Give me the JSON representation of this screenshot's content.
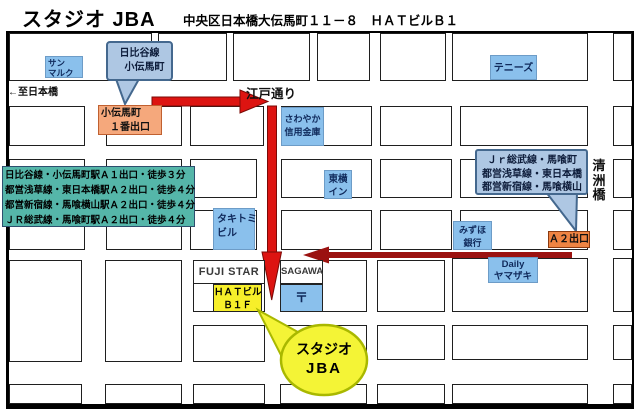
{
  "header": {
    "title": "スタジオ JBA",
    "address": "中央区日本橋大伝馬町１１－８　ＨＡＴビルＢ１"
  },
  "roads": {
    "to_nihonbashi": "←至日本橋",
    "edo_dori": "江戸通り",
    "kiyosubashi": [
      "清",
      "洲",
      "橋"
    ]
  },
  "station_callout": {
    "line1": "日比谷線",
    "line2": "小伝馬町"
  },
  "exits": {
    "kodemmacho_exit1": {
      "line1": "小伝馬町",
      "line2": "１番出口"
    },
    "a2": "Ａ２出口"
  },
  "access_info": {
    "lines": [
      "日比谷線・小伝馬町駅Ａ１出口・徒歩３分",
      "都営浅草線・東日本橋駅Ａ２出口・徒歩４分",
      "都営新宿線・馬喰横山駅Ａ２出口・徒歩４分",
      "ＪＲ総武線・馬喰町駅Ａ２出口・徒歩４分"
    ]
  },
  "jr_callout": {
    "lines": [
      "Ｊｒ総武線・馬喰町",
      "都営浅草線・東日本橋",
      "都営新宿線・馬喰横山"
    ]
  },
  "places": {
    "sunmarc": {
      "line1": "サン",
      "line2": "マルク"
    },
    "tennies": "テニーズ",
    "sawayaka": {
      "line1": "さわやか",
      "line2": "信用金庫"
    },
    "toyoko_inn": {
      "line1": "東横",
      "line2": "イン"
    },
    "takitomi": {
      "line1": "タキトミ",
      "line2": "ビル"
    },
    "mizuho": {
      "line1": "みずほ",
      "line2": "銀行"
    },
    "daily_yamazaki": {
      "line1": "Daily",
      "line2": "ヤマザキ"
    },
    "fuji_star": "FUJI STAR",
    "sagawa": "SAGAWA",
    "post_mark": "〒",
    "hat_building": {
      "line1": "ＨＡＴビル",
      "line2": "Ｂ１Ｆ"
    }
  },
  "balloon": {
    "line1": "スタジオ",
    "line2": "JBA"
  },
  "colors": {
    "route_red": "#dd1411",
    "route_dark_red": "#9b1210",
    "facility_blue": "#8ac0ec",
    "callout_blue": "#aec7e3",
    "callout_border": "#44688e",
    "exit1_orange": "#f5a87c",
    "a2_orange": "#ef8443",
    "access_teal": "#55b6a9",
    "highlight_yellow": "#f7ef2a",
    "balloon_yellow": "#f4f436",
    "balloon_border": "#a9b800"
  }
}
